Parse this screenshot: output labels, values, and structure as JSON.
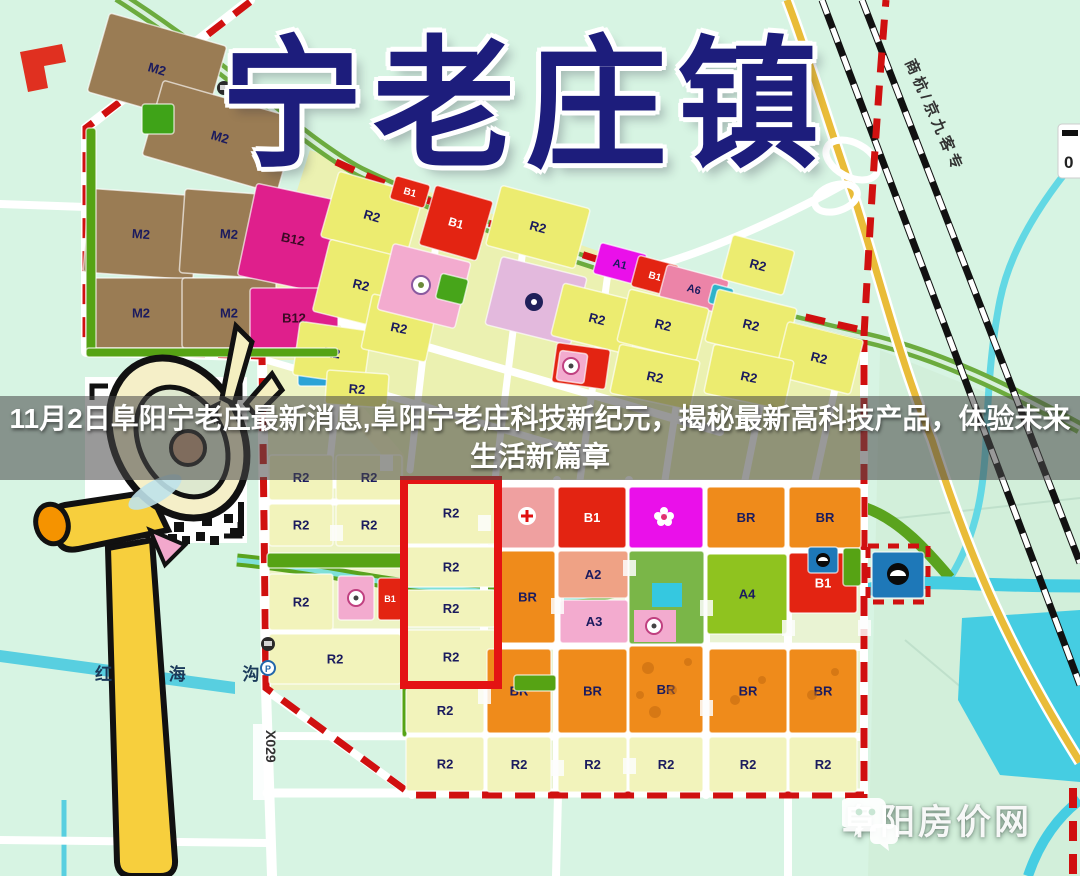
{
  "page": {
    "town_title": "宁老庄镇"
  },
  "banner": {
    "line1": "11月2日阜阳宁老庄最新消息,阜阳宁老庄科技新纪元，揭秘最新高科技产品，体验未来",
    "line2": "生活新篇章"
  },
  "watermark": {
    "site_name": "阜阳房价网"
  },
  "map": {
    "labels": {
      "canal": "红 海 沟",
      "county_road": "X029",
      "railway": "商杭/京九客专",
      "scale_zero": "0"
    },
    "zone_colors": {
      "residential_R2_bright": "#ecec70",
      "residential_R2_pale": "#f2f3bb",
      "industrial_M2": "#9a7c54",
      "commercial_B12": "#df1f8c",
      "commercial_B1": "#e32412",
      "mixed_BR": "#ef8b1b",
      "culture_A1": "#ea10ea",
      "admin_A2": "#efa285",
      "education_A3": "#f3abcf",
      "health_A4": "#8fc31f",
      "A6": "#ec84a8",
      "utility_U9": "#2ba3d6",
      "water_blue": "#1e78b8",
      "green_strip": "#56a314",
      "boundary_red": "#d01010"
    },
    "parcels": [
      {
        "c": "M2",
        "x": 96,
        "y": 28,
        "w": 122,
        "h": 82,
        "f": "#9a7c54",
        "rot": 16
      },
      {
        "c": "M2",
        "x": 150,
        "y": 98,
        "w": 140,
        "h": 78,
        "f": "#9a7c54",
        "rot": 16
      },
      {
        "c": "M2",
        "x": 86,
        "y": 192,
        "w": 110,
        "h": 84,
        "f": "#9a7c54",
        "rot": 4
      },
      {
        "c": "M2",
        "x": 182,
        "y": 192,
        "w": 94,
        "h": 84,
        "f": "#9a7c54",
        "rot": 4
      },
      {
        "c": "M2",
        "x": 86,
        "y": 278,
        "w": 110,
        "h": 70,
        "f": "#9a7c54"
      },
      {
        "c": "M2",
        "x": 182,
        "y": 278,
        "w": 94,
        "h": 70,
        "f": "#9a7c54"
      },
      {
        "c": "",
        "x": 142,
        "y": 104,
        "w": 32,
        "h": 30,
        "f": "#3fa318"
      },
      {
        "c": "B12",
        "x": 246,
        "y": 192,
        "w": 94,
        "h": 94,
        "f": "#df1f8c",
        "rot": 12,
        "tc": "#3a0a24"
      },
      {
        "c": "B12",
        "x": 250,
        "y": 288,
        "w": 88,
        "h": 60,
        "f": "#df1f8c",
        "tc": "#3a0a24"
      },
      {
        "c": "U9",
        "x": 298,
        "y": 348,
        "w": 32,
        "h": 38,
        "f": "#2ba3d6",
        "fs": 10
      },
      {
        "c": "R2",
        "x": 328,
        "y": 182,
        "w": 88,
        "h": 68,
        "f": "#ecec70",
        "rot": 16
      },
      {
        "c": "R2",
        "x": 320,
        "y": 248,
        "w": 82,
        "h": 74,
        "f": "#ecec70",
        "rot": 14
      },
      {
        "c": "R2",
        "x": 296,
        "y": 326,
        "w": 72,
        "h": 54,
        "f": "#ecec70",
        "rot": 8
      },
      {
        "c": "R2",
        "x": 366,
        "y": 300,
        "w": 66,
        "h": 56,
        "f": "#ecec70",
        "rot": 12
      },
      {
        "c": "R2",
        "x": 326,
        "y": 372,
        "w": 62,
        "h": 34,
        "f": "#ecec70",
        "rot": 4
      },
      {
        "c": "B1",
        "x": 392,
        "y": 180,
        "w": 36,
        "h": 24,
        "f": "#e32412",
        "rot": 16,
        "fs": 10,
        "tc": "#fff"
      },
      {
        "c": "B1",
        "x": 426,
        "y": 192,
        "w": 60,
        "h": 62,
        "f": "#e32412",
        "rot": 16,
        "fs": 12,
        "tc": "#fff"
      },
      {
        "c": "R2",
        "x": 492,
        "y": 196,
        "w": 92,
        "h": 62,
        "f": "#ecec70",
        "rot": 15
      },
      {
        "c": "",
        "x": 384,
        "y": 252,
        "w": 80,
        "h": 68,
        "f": "#f3abcf",
        "rot": 14
      },
      {
        "c": "",
        "x": 438,
        "y": 276,
        "w": 28,
        "h": 26,
        "f": "#47a51a",
        "rot": 14
      },
      {
        "c": "",
        "x": 492,
        "y": 266,
        "w": 88,
        "h": 70,
        "f": "#e3b9dd",
        "rot": 14
      },
      {
        "c": "A1",
        "x": 596,
        "y": 248,
        "w": 48,
        "h": 32,
        "f": "#ea10ea",
        "rot": 15,
        "fs": 11
      },
      {
        "c": "B1",
        "x": 634,
        "y": 260,
        "w": 42,
        "h": 32,
        "f": "#e32412",
        "rot": 15,
        "fs": 10,
        "tc": "#fff"
      },
      {
        "c": "A6",
        "x": 662,
        "y": 272,
        "w": 64,
        "h": 34,
        "f": "#ec84a8",
        "rot": 15,
        "fs": 11
      },
      {
        "c": "",
        "x": 710,
        "y": 286,
        "w": 22,
        "h": 20,
        "f": "#2db3c9",
        "rot": 15
      },
      {
        "c": "R2",
        "x": 726,
        "y": 242,
        "w": 64,
        "h": 46,
        "f": "#ecec70",
        "rot": 15
      },
      {
        "c": "R2",
        "x": 556,
        "y": 292,
        "w": 82,
        "h": 54,
        "f": "#ecec70",
        "rot": 14
      },
      {
        "c": "R2",
        "x": 622,
        "y": 298,
        "w": 82,
        "h": 54,
        "f": "#ecec70",
        "rot": 14
      },
      {
        "c": "R2",
        "x": 710,
        "y": 298,
        "w": 82,
        "h": 54,
        "f": "#ecec70",
        "rot": 14
      },
      {
        "c": "R2",
        "x": 780,
        "y": 330,
        "w": 78,
        "h": 56,
        "f": "#ecec70",
        "rot": 14
      },
      {
        "c": "R2",
        "x": 614,
        "y": 352,
        "w": 82,
        "h": 50,
        "f": "#ecec70",
        "rot": 12
      },
      {
        "c": "R2",
        "x": 708,
        "y": 352,
        "w": 82,
        "h": 50,
        "f": "#ecec70",
        "rot": 12
      },
      {
        "c": "",
        "x": 554,
        "y": 346,
        "w": 54,
        "h": 40,
        "f": "#e32412",
        "rot": 8
      },
      {
        "c": "",
        "x": 558,
        "y": 352,
        "w": 28,
        "h": 30,
        "f": "#f3abcf",
        "rot": 8
      },
      {
        "c": "",
        "x": 86,
        "y": 128,
        "w": 10,
        "h": 224,
        "f": "#56a314"
      },
      {
        "c": "",
        "x": 86,
        "y": 348,
        "w": 252,
        "h": 9,
        "f": "#56a314"
      },
      {
        "c": "R2",
        "x": 269,
        "y": 455,
        "w": 64,
        "h": 45,
        "f": "#f2f3bb"
      },
      {
        "c": "R2",
        "x": 336,
        "y": 455,
        "w": 66,
        "h": 45,
        "f": "#f2f3bb"
      },
      {
        "c": "R2",
        "x": 269,
        "y": 504,
        "w": 64,
        "h": 42,
        "f": "#f2f3bb"
      },
      {
        "c": "R2",
        "x": 336,
        "y": 504,
        "w": 66,
        "h": 42,
        "f": "#f2f3bb"
      },
      {
        "c": "",
        "x": 267,
        "y": 553,
        "w": 138,
        "h": 15,
        "f": "#56a314"
      },
      {
        "c": "R2",
        "x": 269,
        "y": 574,
        "w": 64,
        "h": 56,
        "f": "#f2f3bb"
      },
      {
        "c": "",
        "x": 338,
        "y": 576,
        "w": 36,
        "h": 44,
        "f": "#f3abcf"
      },
      {
        "c": "B1",
        "x": 378,
        "y": 578,
        "w": 24,
        "h": 42,
        "f": "#e32412",
        "fs": 9,
        "tc": "#fff"
      },
      {
        "c": "R2",
        "x": 269,
        "y": 634,
        "w": 132,
        "h": 50,
        "f": "#f2f3bb"
      },
      {
        "c": "",
        "x": 402,
        "y": 482,
        "w": 5,
        "h": 255,
        "f": "#56a314"
      },
      {
        "c": "R2",
        "x": 406,
        "y": 482,
        "w": 90,
        "h": 62,
        "f": "#f2f3bb"
      },
      {
        "c": "R2",
        "x": 406,
        "y": 547,
        "w": 90,
        "h": 40,
        "f": "#f2f3bb"
      },
      {
        "c": "R2",
        "x": 406,
        "y": 590,
        "w": 90,
        "h": 37,
        "f": "#f2f3bb"
      },
      {
        "c": "R2",
        "x": 406,
        "y": 630,
        "w": 90,
        "h": 54,
        "f": "#f2f3bb"
      },
      {
        "c": "R2",
        "x": 406,
        "y": 688,
        "w": 78,
        "h": 45,
        "f": "#f2f3bb"
      },
      {
        "c": "R2",
        "x": 406,
        "y": 737,
        "w": 78,
        "h": 54,
        "f": "#f2f3bb"
      },
      {
        "c": "",
        "x": 500,
        "y": 487,
        "w": 55,
        "h": 61,
        "f": "#efa0a0"
      },
      {
        "c": "B1",
        "x": 558,
        "y": 487,
        "w": 68,
        "h": 61,
        "f": "#e32412",
        "tc": "#fff"
      },
      {
        "c": "",
        "x": 629,
        "y": 487,
        "w": 74,
        "h": 61,
        "f": "#ea10ea"
      },
      {
        "c": "BR",
        "x": 707,
        "y": 487,
        "w": 78,
        "h": 61,
        "f": "#ef8b1b"
      },
      {
        "c": "BR",
        "x": 789,
        "y": 487,
        "w": 72,
        "h": 61,
        "f": "#ef8b1b"
      },
      {
        "c": "BR",
        "x": 500,
        "y": 551,
        "w": 55,
        "h": 92,
        "f": "#ef8b1b"
      },
      {
        "c": "A2",
        "x": 558,
        "y": 551,
        "w": 70,
        "h": 47,
        "f": "#efa285"
      },
      {
        "c": "A3",
        "x": 560,
        "y": 600,
        "w": 68,
        "h": 43,
        "f": "#f3abcf"
      },
      {
        "c": "",
        "x": 629,
        "y": 551,
        "w": 75,
        "h": 93,
        "f": "#7ab648"
      },
      {
        "c": "A4",
        "x": 707,
        "y": 554,
        "w": 80,
        "h": 80,
        "f": "#8fc31f"
      },
      {
        "c": "B1",
        "x": 789,
        "y": 553,
        "w": 68,
        "h": 60,
        "f": "#e32412",
        "tc": "#fff"
      },
      {
        "c": "",
        "x": 843,
        "y": 548,
        "w": 18,
        "h": 38,
        "f": "#56a314"
      },
      {
        "c": "",
        "x": 808,
        "y": 547,
        "w": 30,
        "h": 26,
        "f": "#1e78b8"
      },
      {
        "c": "BR",
        "x": 487,
        "y": 649,
        "w": 64,
        "h": 84,
        "f": "#ef8b1b"
      },
      {
        "c": "BR",
        "x": 558,
        "y": 649,
        "w": 69,
        "h": 84,
        "f": "#ef8b1b"
      },
      {
        "c": "BR",
        "x": 629,
        "y": 646,
        "w": 74,
        "h": 87,
        "f": "#ef8b1b"
      },
      {
        "c": "BR",
        "x": 709,
        "y": 649,
        "w": 78,
        "h": 84,
        "f": "#ef8b1b"
      },
      {
        "c": "BR",
        "x": 789,
        "y": 649,
        "w": 68,
        "h": 84,
        "f": "#ef8b1b"
      },
      {
        "c": "",
        "x": 514,
        "y": 675,
        "w": 42,
        "h": 16,
        "f": "#56a314"
      },
      {
        "c": "R2",
        "x": 487,
        "y": 737,
        "w": 64,
        "h": 55,
        "f": "#f2f3bb"
      },
      {
        "c": "R2",
        "x": 558,
        "y": 737,
        "w": 69,
        "h": 55,
        "f": "#f2f3bb"
      },
      {
        "c": "R2",
        "x": 629,
        "y": 737,
        "w": 74,
        "h": 55,
        "f": "#f2f3bb"
      },
      {
        "c": "R2",
        "x": 709,
        "y": 737,
        "w": 78,
        "h": 55,
        "f": "#f2f3bb"
      },
      {
        "c": "R2",
        "x": 789,
        "y": 737,
        "w": 68,
        "h": 55,
        "f": "#f2f3bb"
      },
      {
        "c": "",
        "x": 872,
        "y": 552,
        "w": 52,
        "h": 46,
        "f": "#1e78b8"
      }
    ]
  }
}
